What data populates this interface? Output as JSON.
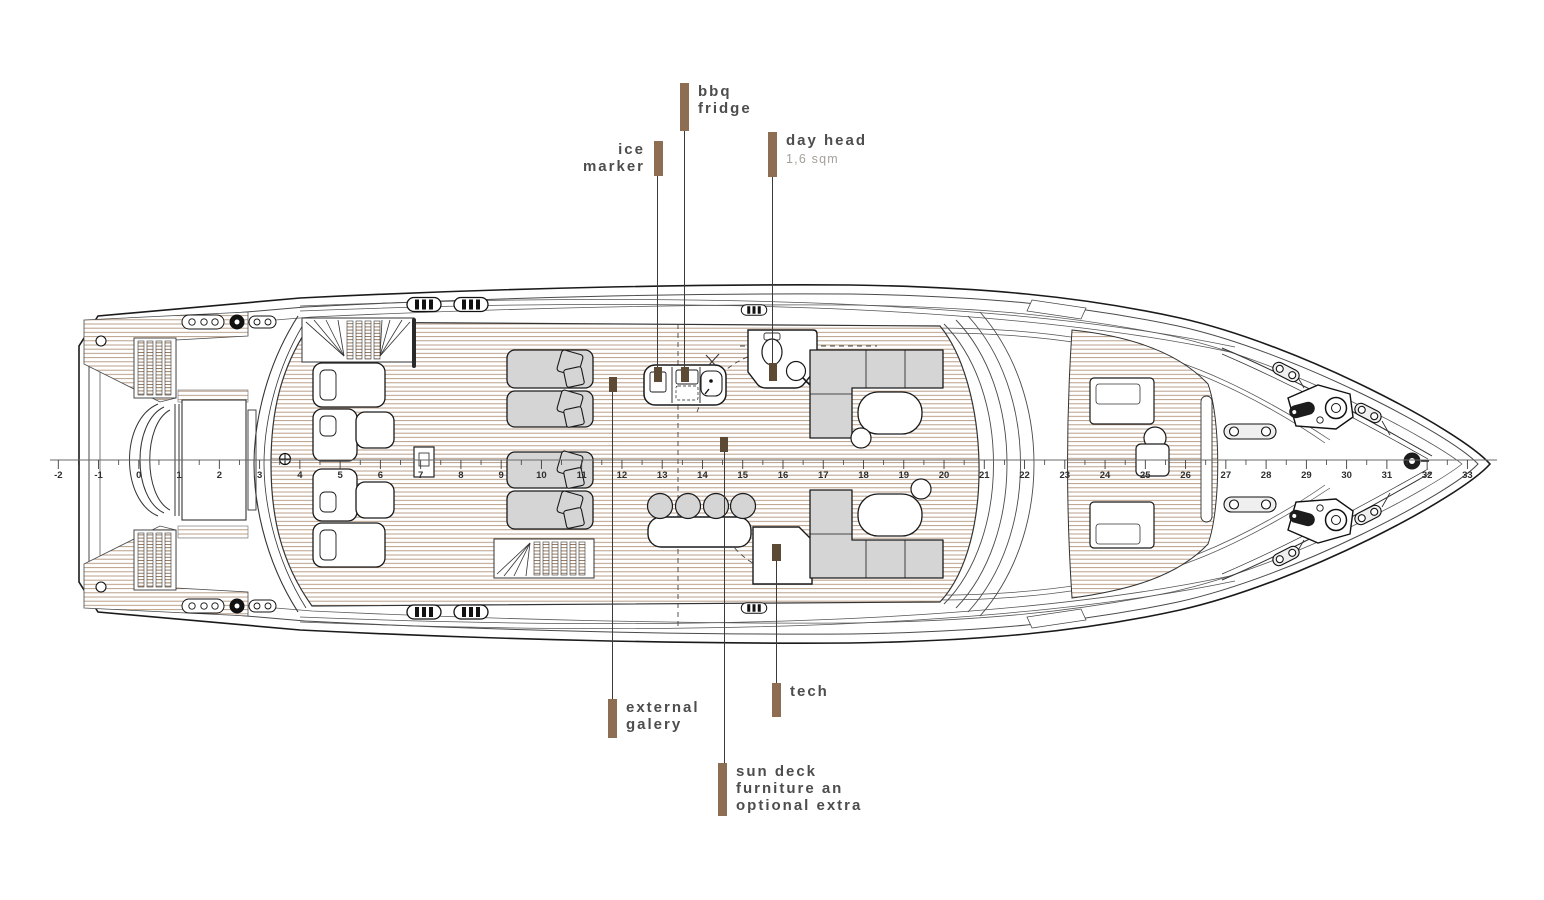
{
  "document": {
    "type": "yacht sun deck general arrangement plan"
  },
  "colors": {
    "annotation_bar": "#8d6e53",
    "annotation_text": "#4d4d4d",
    "annotation_subtext": "#a5a09a",
    "leader_line": "#3a3a3a",
    "teak_stripe": "#b2947a",
    "furniture_fill": "#d5d5d5",
    "outline": "#1a1a1a",
    "target_marker": "#5d4a35"
  },
  "annotations": {
    "bbq_fridge": {
      "line1": "bbq",
      "line2": "fridge"
    },
    "ice_marker": {
      "line1": "ice",
      "line2": "marker"
    },
    "day_head": {
      "title": "day head",
      "area": "1,6 sqm"
    },
    "external_gallery": {
      "line1": "external",
      "line2": "galery"
    },
    "tech": {
      "title": "tech"
    },
    "sun_deck_note": {
      "line1": "sun deck",
      "line2": "furniture an",
      "line3": "optional extra"
    }
  },
  "ruler": {
    "numbers": [
      -2,
      -1,
      0,
      1,
      2,
      3,
      4,
      5,
      6,
      7,
      8,
      9,
      10,
      11,
      12,
      13,
      14,
      15,
      16,
      17,
      18,
      19,
      20,
      21,
      22,
      23,
      24,
      25,
      26,
      27,
      28,
      29,
      30,
      31,
      32,
      33
    ]
  }
}
